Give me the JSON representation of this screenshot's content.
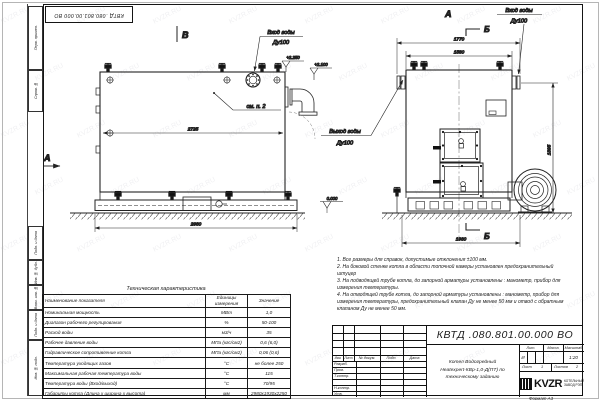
{
  "watermark": "KVZR.RU",
  "sheet": {
    "doc_number": "КВТД .080.801.00.000  ВО",
    "format_label": "Формат  А3",
    "margin_labels": [
      "Перв. примен.",
      "Справ. №",
      "Подп. и дата",
      "Инв. № дубл.",
      "Взам. инв. №",
      "Подп. и дата",
      "Инв. № подл."
    ]
  },
  "drawing": {
    "labels": {
      "view_b": "В",
      "view_a_side": "А",
      "view_a_front": "А",
      "section_b_top": "Б",
      "section_b_bottom": "Б",
      "see_item": "см. п. 2"
    },
    "callouts": {
      "inlet_top": "Вход воды",
      "inlet_top_dn": "Ду100",
      "inlet_front": "Вход воды",
      "inlet_front_dn": "Ду100",
      "outlet": "Выход воды",
      "outlet_dn": "Ду100",
      "elev_top": "+2.250",
      "elev_mid": "+2.100",
      "elev_zero": "0.000"
    },
    "dims": {
      "side_length": "2725",
      "side_length_full": "2980",
      "front_width_flanges": "1770",
      "front_width_body": "1560",
      "front_height": "1895",
      "front_width_base": "1930"
    }
  },
  "notes": {
    "n1": "1. Все размеры для справок, допустимые отклонения ±100 мм.",
    "n2": "2. На боковой стенке котла в области топочной камеры установлен предохранительный штуцер",
    "n3": "3. На подводящей трубе котла, до запорной арматуры установлены : манометр, прибор для измерения температуры.",
    "n4": "4. На отводящей трубе котла, до запорной арматуры установлены : манометр, прибор для измерения температуры, предохранительный клапан Ду не менее 50 мм и отвод с обратным клапаном Ду не менее 50 мм."
  },
  "table": {
    "title": "Техническая характеристика",
    "headers": [
      "Наименование показателя",
      "Единицы измерения",
      "Значение"
    ],
    "rows": [
      [
        "Номинальная мощность",
        "МВт",
        "1,0"
      ],
      [
        "Диапазон рабочего регулирования",
        "%",
        "50-100"
      ],
      [
        "Расход воды",
        "м3/ч",
        "35"
      ],
      [
        "Рабочее давление воды",
        "МПа (кгс/см2)",
        "0,6 (6,0)"
      ],
      [
        "Гидравлическое сопротивление котла",
        "МПа (кгс/см2)",
        "0,06 (0,6)"
      ],
      [
        "Температура уходящих газов",
        "°С",
        "не более 250"
      ],
      [
        "Максимальная рабочая температура воды",
        "°С",
        "115"
      ],
      [
        "Температура воды (Вход/выход)",
        "°С",
        "70/95"
      ],
      [
        "Габариты котла (Длина х ширина х высота)",
        "мм",
        "2980х1930х2250"
      ]
    ]
  },
  "titleblock": {
    "doc_number": "КВТД .080.801.00.000  ВО",
    "header_cells": [
      "Изм.",
      "Лист",
      "№ докум.",
      "Подп.",
      "Дата"
    ],
    "row_labels": [
      "Разраб.",
      "Пров.",
      "Т.контр.",
      "",
      "Н.контр.",
      "Утв."
    ],
    "product_line1": "Котел Водогрейный",
    "product_line2": "Heatexpert-КВр-1,0-Д(ПТ) по",
    "product_line3": "техническому заданию",
    "lit_label": "Лит.",
    "lit_value": "И",
    "mass_label": "Масса",
    "scale_label": "Масштаб",
    "scale_value": "1:20",
    "sheet_label": "Лист",
    "sheet_value": "1",
    "sheets_label": "Листов",
    "sheets_value": "2",
    "company_logo": "KVZR",
    "company_line1": "КОТЕЛЬНЫЙ",
    "company_line2": "ЗАВОД РЭП"
  }
}
